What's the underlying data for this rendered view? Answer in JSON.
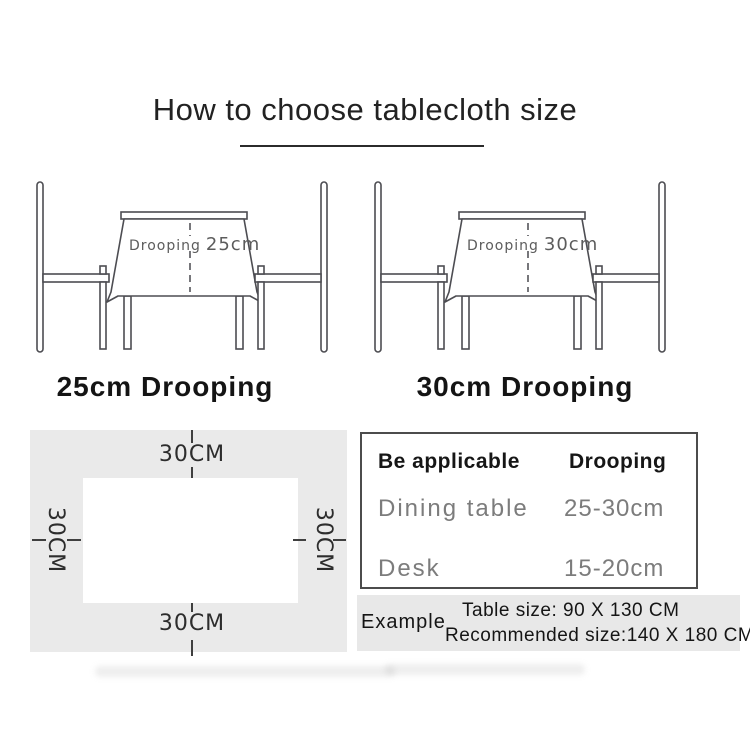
{
  "title": "How to choose tablecloth size",
  "illustrations": {
    "left": {
      "cloth_prefix": "Drooping",
      "cloth_value": "25cm",
      "caption": "25cm Drooping"
    },
    "right": {
      "cloth_prefix": "Drooping",
      "cloth_value": "30cm",
      "caption": "30cm Drooping"
    }
  },
  "size_diagram": {
    "top_label": "30CM",
    "bottom_label": "30CM",
    "left_label": "30CM",
    "right_label": "30CM"
  },
  "spec_table": {
    "header": {
      "applicable": "Be applicable",
      "drooping": "Drooping"
    },
    "rows": [
      {
        "name": "Dining table",
        "value": "25-30cm"
      },
      {
        "name": "Desk",
        "value": "15-20cm"
      }
    ]
  },
  "example": {
    "label": "Example",
    "table_size": "Table size:  90 X 130 CM",
    "recommended_size": "Recommended size:140 X 180 CM"
  }
}
